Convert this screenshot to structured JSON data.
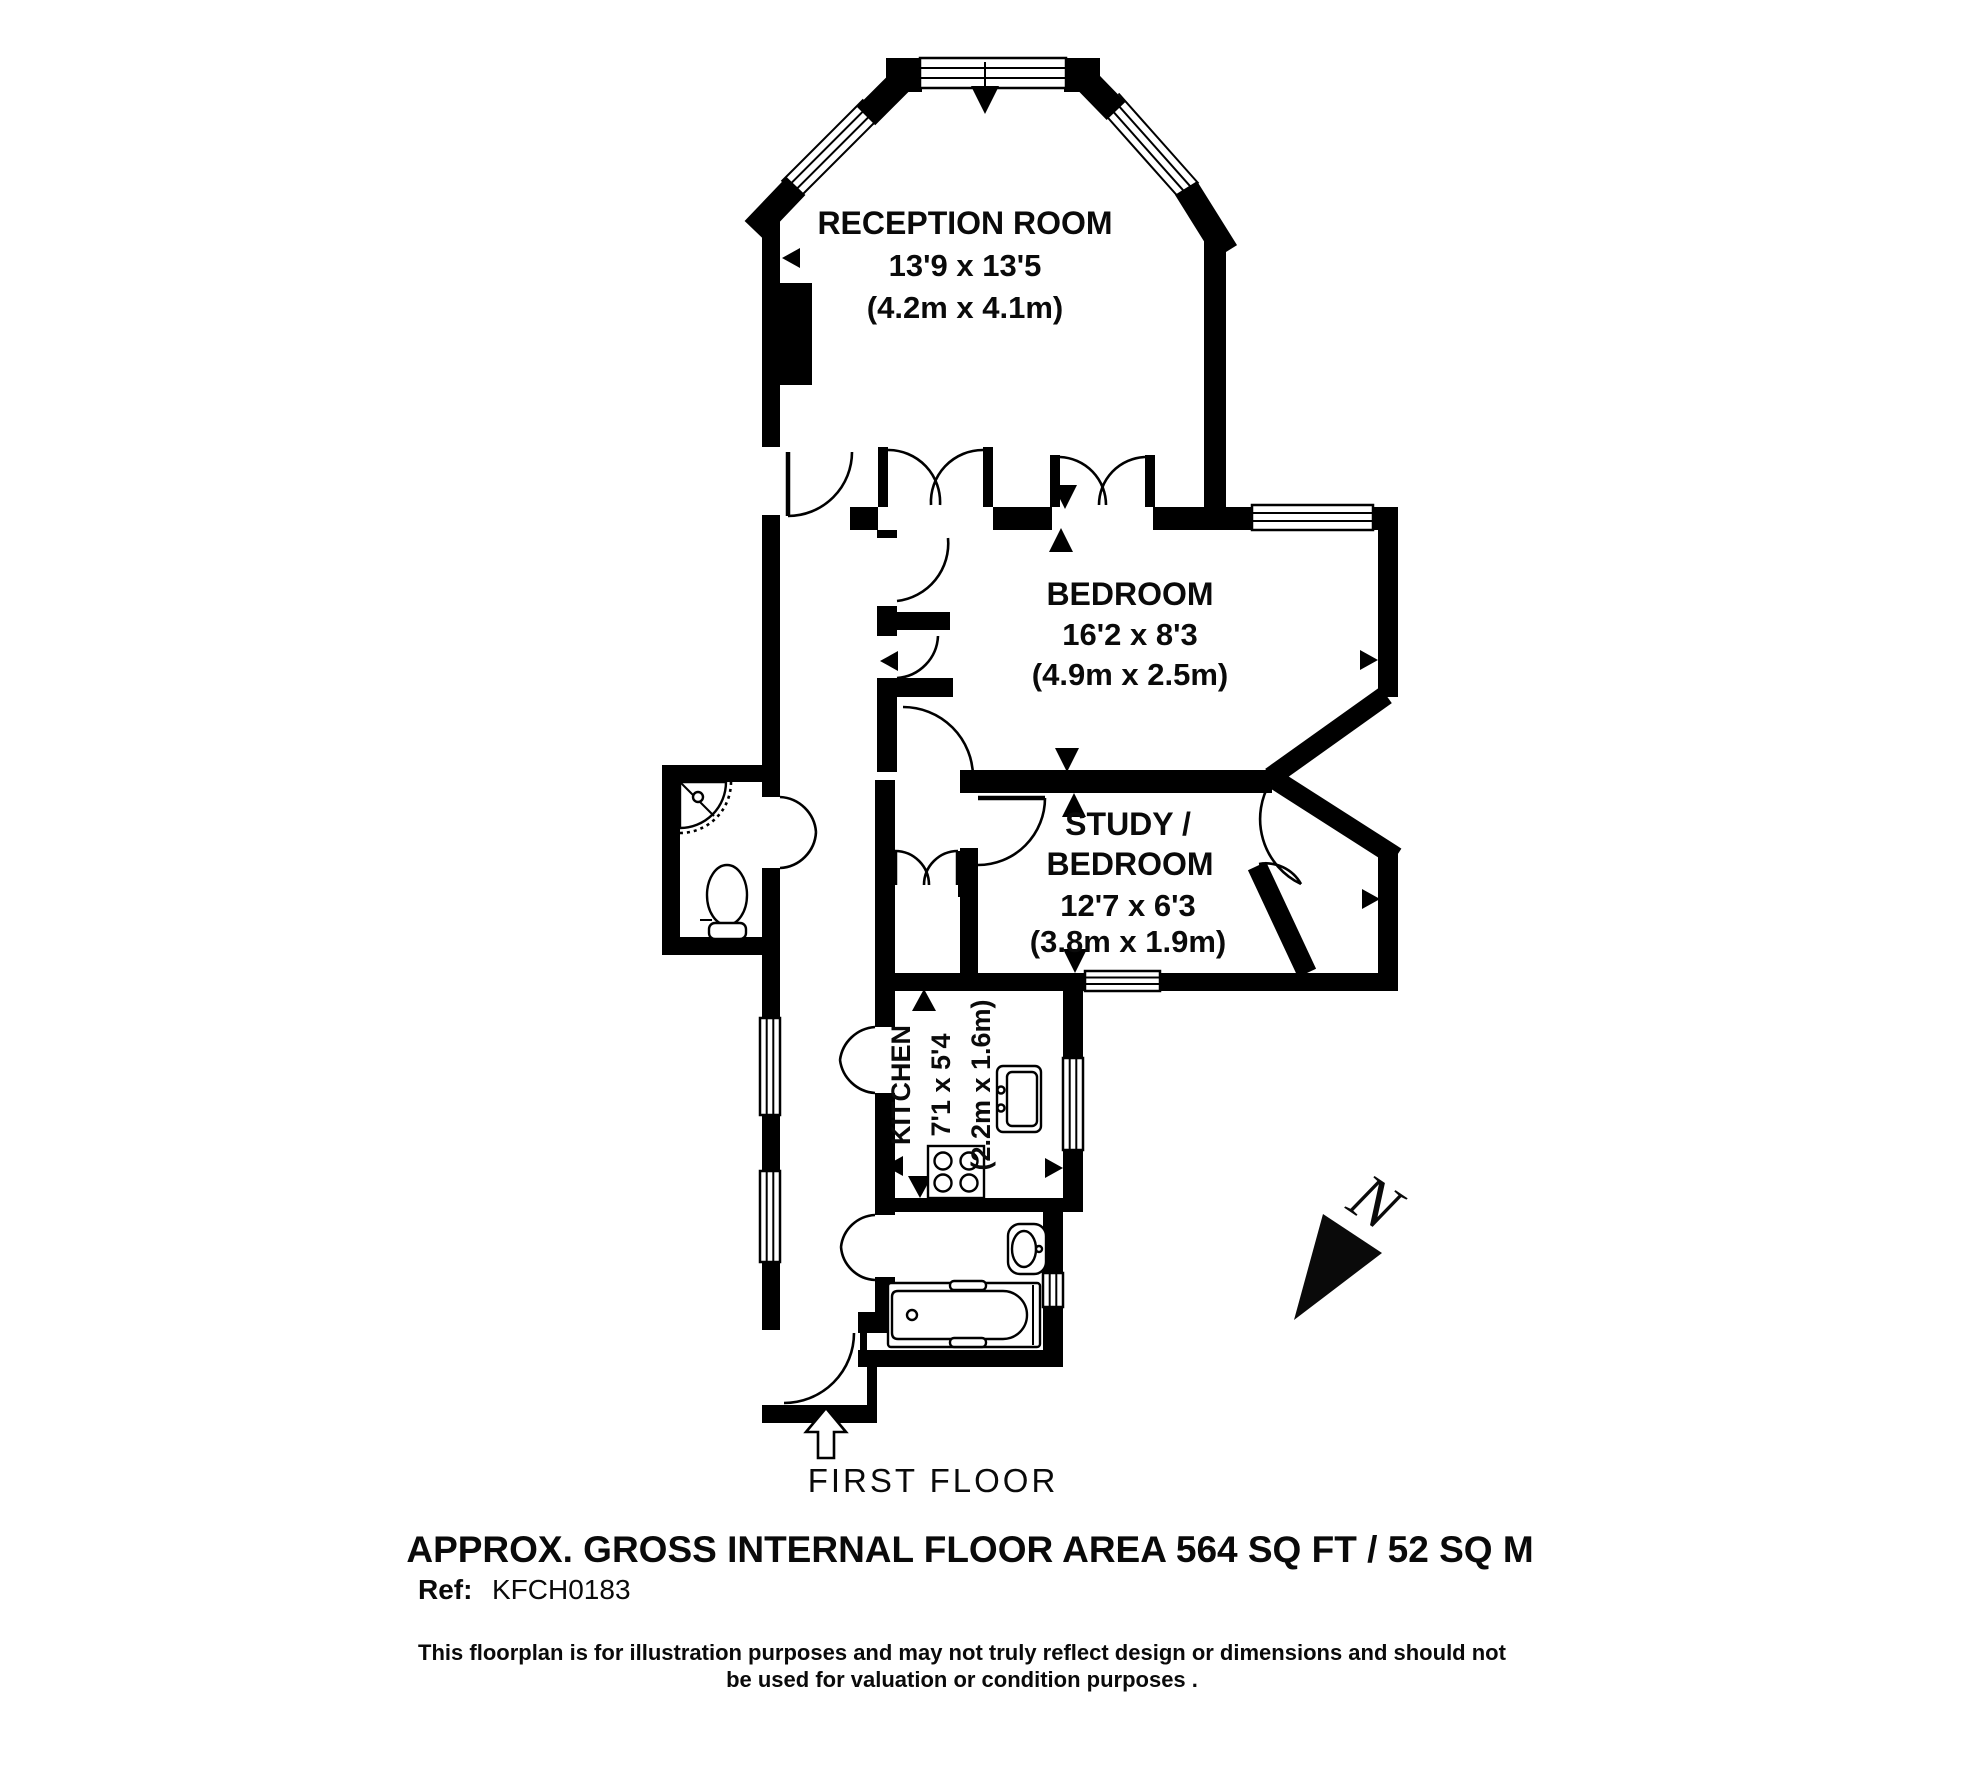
{
  "plan": {
    "floor_label": "FIRST FLOOR",
    "area_label": "APPROX. GROSS INTERNAL FLOOR AREA 564 SQ FT / 52 SQ M",
    "ref_label": "Ref:",
    "ref_value": "KFCH0183",
    "disclaimer_line1": "This floorplan is for illustration purposes and may not truly reflect design or dimensions and should not",
    "disclaimer_line2": "be used for valuation or condition purposes .",
    "north_label": "N",
    "rooms": {
      "reception": {
        "name": "RECEPTION ROOM",
        "dims_imperial": "13'9 x 13'5",
        "dims_metric": "(4.2m x 4.1m)"
      },
      "bedroom": {
        "name": "BEDROOM",
        "dims_imperial": "16'2 x 8'3",
        "dims_metric": "(4.9m x 2.5m)"
      },
      "study": {
        "name_line1": "STUDY /",
        "name_line2": "BEDROOM",
        "dims_imperial": "12'7 x 6'3",
        "dims_metric": "(3.8m x 1.9m)"
      },
      "kitchen": {
        "name": "KITCHEN",
        "dims_imperial": "7'1 x 5'4",
        "dims_metric": "(2.2m x 1.6m)"
      }
    },
    "colors": {
      "wall": "#000000",
      "background": "#ffffff"
    }
  }
}
